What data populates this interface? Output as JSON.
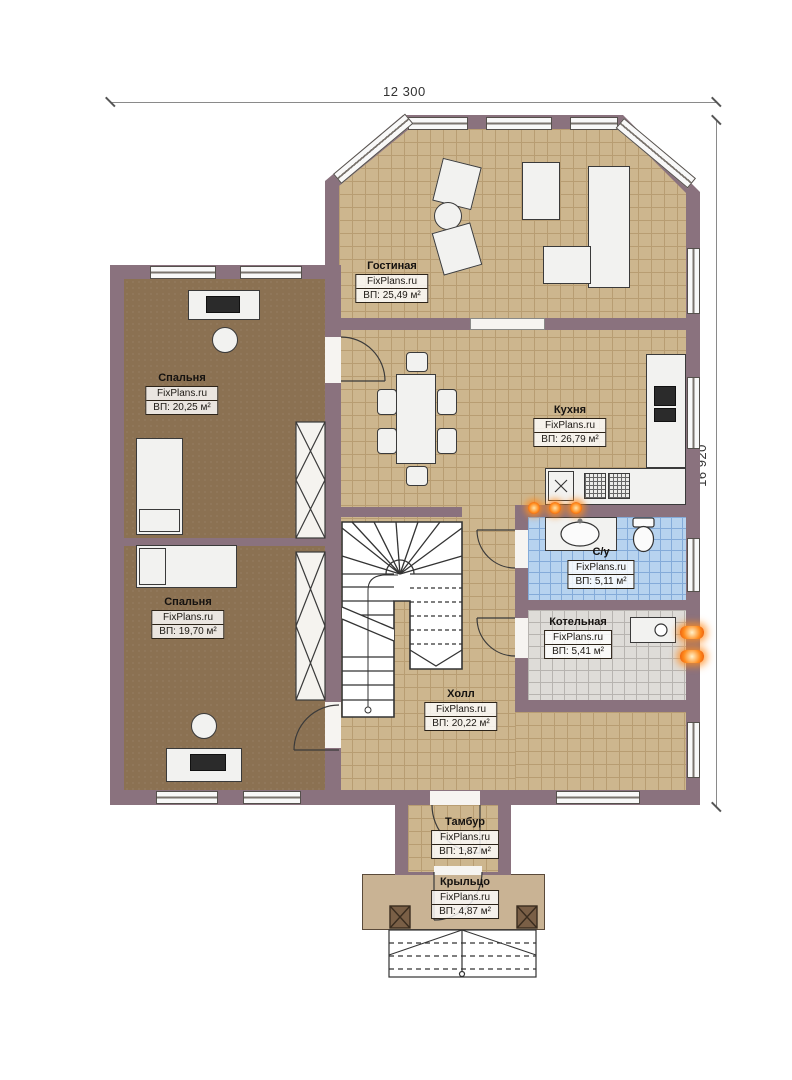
{
  "title": "Floor plan (first floor)",
  "dimensions": {
    "width_label": "12 300",
    "height_label": "16 920"
  },
  "rooms": [
    {
      "id": "living",
      "name": "Гостиная",
      "site": "FixPlans.ru",
      "area": "ВП: 25,49 м²"
    },
    {
      "id": "bedroom1",
      "name": "Спальня",
      "site": "FixPlans.ru",
      "area": "ВП: 20,25 м²"
    },
    {
      "id": "kitchen",
      "name": "Кухня",
      "site": "FixPlans.ru",
      "area": "ВП: 26,79 м²"
    },
    {
      "id": "bedroom2",
      "name": "Спальня",
      "site": "FixPlans.ru",
      "area": "ВП: 19,70 м²"
    },
    {
      "id": "bathroom",
      "name": "С/у",
      "site": "FixPlans.ru",
      "area": "ВП: 5,11 м²"
    },
    {
      "id": "boiler",
      "name": "Котельная",
      "site": "FixPlans.ru",
      "area": "ВП: 5,41 м²"
    },
    {
      "id": "hall",
      "name": "Холл",
      "site": "FixPlans.ru",
      "area": "ВП: 20,22 м²"
    },
    {
      "id": "tambur",
      "name": "Тамбур",
      "site": "FixPlans.ru",
      "area": "ВП: 1,87 м²"
    },
    {
      "id": "porch",
      "name": "Крыльцо",
      "site": "FixPlans.ru",
      "area": "ВП: 4,87 м²"
    }
  ],
  "palette": {
    "wall": "#8a727e",
    "floor_tile": "#cdb68e",
    "bedroom_floor": "#8b7152",
    "bathroom_tile": "#b7d3ef",
    "boiler_tile": "#dedcd8",
    "porch": "#c9b394",
    "heat_accent": "#ff8c1e",
    "label_border": "#2c2318"
  }
}
